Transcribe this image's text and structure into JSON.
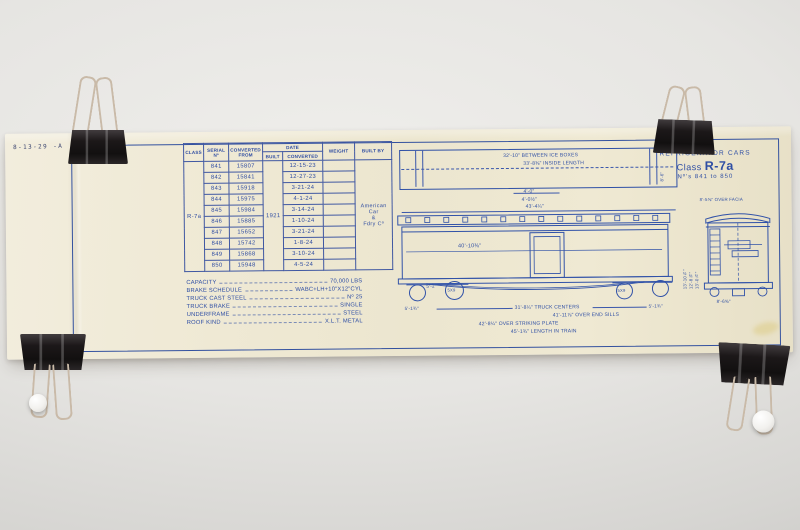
{
  "note": "8-13-29 -A",
  "title_block": {
    "line1": "MILK",
    "line2": "REFRIGERATOR CARS",
    "class_word": "Class",
    "class_name": "R-7a",
    "range": "Nº’s 841 to 850"
  },
  "table": {
    "headers": {
      "class": "Class",
      "serial": "Serial Nº",
      "converted_from": "Converted From",
      "date": "Date",
      "built": "Built",
      "converted": "Converted",
      "weight": "Weight",
      "built_by": "Built By"
    },
    "class_value": "R-7a",
    "built_value": "1921",
    "built_by_value": "American\nCar\n&\nFdry Cº",
    "rows": [
      {
        "car": "841",
        "serial": "15807",
        "converted": "12-15-23"
      },
      {
        "car": "842",
        "serial": "15841",
        "converted": "12-27-23"
      },
      {
        "car": "843",
        "serial": "15918",
        "converted": "3-21-24"
      },
      {
        "car": "844",
        "serial": "15975",
        "converted": "4-1-24"
      },
      {
        "car": "845",
        "serial": "15984",
        "converted": "3-14-24"
      },
      {
        "car": "846",
        "serial": "15885",
        "converted": "1-10-24"
      },
      {
        "car": "847",
        "serial": "15652",
        "converted": "3-21-24"
      },
      {
        "car": "848",
        "serial": "15742",
        "converted": "1-8-24"
      },
      {
        "car": "849",
        "serial": "15868",
        "converted": "3-10-24"
      },
      {
        "car": "850",
        "serial": "15948",
        "converted": "4-5-24"
      }
    ]
  },
  "specs": {
    "rows": [
      {
        "label": "Capacity",
        "value": "70,000 LBS"
      },
      {
        "label": "Brake Schedule",
        "value": "WABC+LH+10\"x12\"CYL"
      },
      {
        "label": "Truck Cast Steel",
        "value": "Nº 25"
      },
      {
        "label": "Truck Brake",
        "value": "Single"
      },
      {
        "label": "Underframe",
        "value": "Steel"
      },
      {
        "label": "Roof Kind",
        "value": "X.L.T. Metal"
      }
    ]
  },
  "plan_view": {
    "between_ice_boxes": "32'-10\" Between Ice Boxes",
    "inside_length": "33'-8⅜\" Inside Length",
    "height": "8'-6\"",
    "dim_a": "4'-0\"",
    "dim_b": "4'-0½\"",
    "overall": "43'-4¼\""
  },
  "side_view": {
    "inside_length": "40'-10⅜\"",
    "journal": "5x9",
    "dim_left_a": "5'-2\"",
    "dim_left_b": "5'-1¾\"",
    "dim_right": "5'-1¾\"",
    "truck_centers": "31'-8¼\" Truck Centers",
    "over_end_sills": "41'-11⅞\" Over End Sills",
    "over_striking_plate": "42'-8¼\" Over Striking Plate",
    "length_in_train": "45'-1¾\" Length in Train"
  },
  "end_view": {
    "over_facia": "8'-5⅝\" Over Facia",
    "over_sills": "8'-6⅝\"",
    "v_dim_a": "13'-10¾\"",
    "v_dim_b": "12'-8⅝\"",
    "v_dim_c": "13'-0⅞\""
  }
}
